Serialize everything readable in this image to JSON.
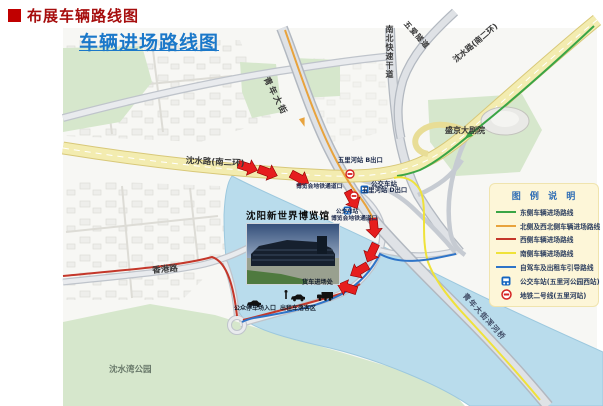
{
  "page": {
    "bullet": "■",
    "title": "布展车辆路线图"
  },
  "map": {
    "title": "车辆进场路线图",
    "roads": {
      "shenshui_w": "沈水路(南二环)",
      "shenshui_e": "沈水路(南二环)",
      "qingnian": "青年大街",
      "nanbei": "南北快速干道",
      "wuai": "五爱隧道",
      "hunhe_bridge": "青年大街浑河桥",
      "xianggang": "香港路"
    },
    "places": {
      "theatre": "盛京大剧院",
      "venue": "沈阳新世界博览馆",
      "park": "沈水湾公园"
    },
    "transit": {
      "exit_b": "五里河站 B出口",
      "exit_d": "五里河站 D出口",
      "bus_stop_1": "公交车站",
      "bus_stop_2": "公交车站",
      "expo_passage_1": "博览会地铁通道口",
      "expo_passage_2": "博览会地铁通道口"
    },
    "facilities": {
      "parking_entrance": "公众停车场入口",
      "taxi_dropoff": "出租车落客区",
      "truck_entrance": "货车进场处"
    },
    "colors": {
      "route_east": "#3aa546",
      "route_north": "#e8a33d",
      "route_west": "#c4372a",
      "route_south": "#efe23a",
      "route_guide": "#2e74c8",
      "arrow": "#e61e1e",
      "title_blue": "#1b78c9",
      "heading_red": "#a60d0d",
      "water": "#b9dcec",
      "highway_yellow": "#f3ecb0"
    }
  },
  "legend": {
    "title": "图 例 说 明",
    "items": [
      {
        "type": "line",
        "color": "#3aa546",
        "label": "东侧车辆进场路线"
      },
      {
        "type": "line",
        "color": "#e8a33d",
        "label": "北侧及西北侧车辆进场路线"
      },
      {
        "type": "line",
        "color": "#c4372a",
        "label": "西侧车辆进场路线"
      },
      {
        "type": "line",
        "color": "#efe23a",
        "label": "南侧车辆进场路线"
      },
      {
        "type": "line",
        "color": "#2e74c8",
        "label": "自驾车及出租车引导路线"
      },
      {
        "type": "bus",
        "label": "公交车站(五里河公园西站)"
      },
      {
        "type": "metro",
        "label": "地铁二号线(五里河站)"
      }
    ]
  }
}
